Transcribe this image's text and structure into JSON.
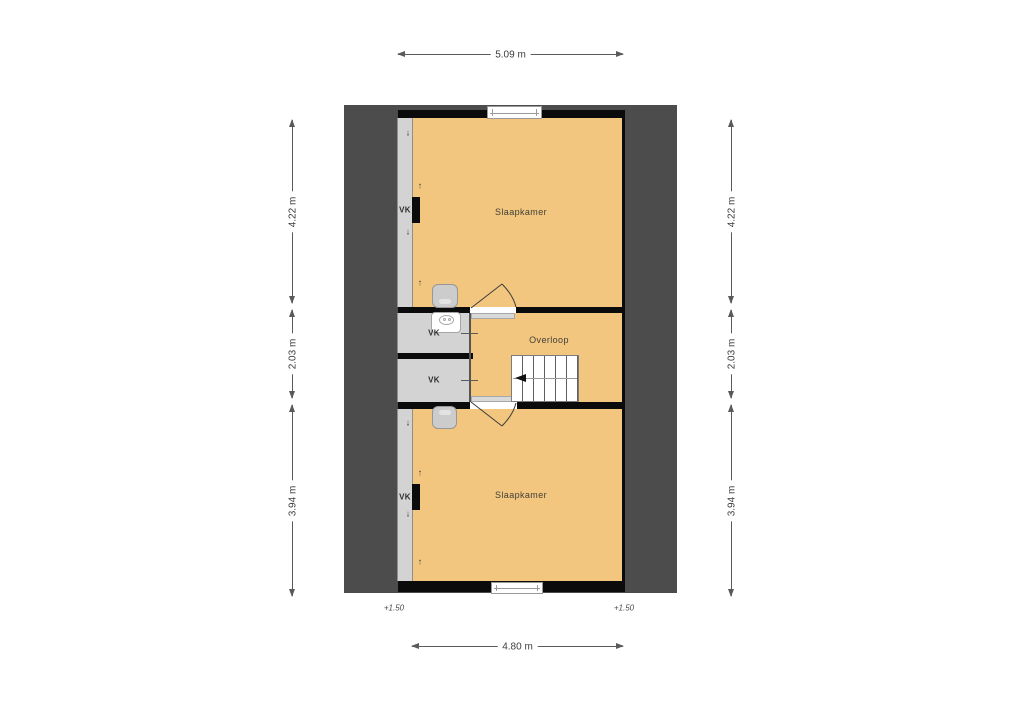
{
  "floorplan": {
    "rooms": {
      "bedroom_top": "Slaapkamer",
      "landing": "Overloop",
      "bedroom_bottom": "Slaapkamer",
      "knee_wall_top": "VK",
      "closet_top": "VK",
      "closet_bottom": "VK",
      "knee_wall_bottom": "VK"
    },
    "dimensions": {
      "top": "5.09 m",
      "bottom": "4.80 m",
      "left_upper": "4.22 m",
      "left_middle": "2.03 m",
      "left_lower": "3.94 m",
      "right_upper": "4.22 m",
      "right_middle": "2.03 m",
      "right_lower": "3.94 m"
    },
    "elevations": {
      "left": "+1.50",
      "right": "+1.50"
    },
    "icons": {
      "slope_up": "↑",
      "slope_down": "↓"
    },
    "colors": {
      "floor": "#F2C67E",
      "roof_zone": "#4C4C4C",
      "knee_zone": "#D3D3D3",
      "wall": "#0B0B0B"
    }
  }
}
